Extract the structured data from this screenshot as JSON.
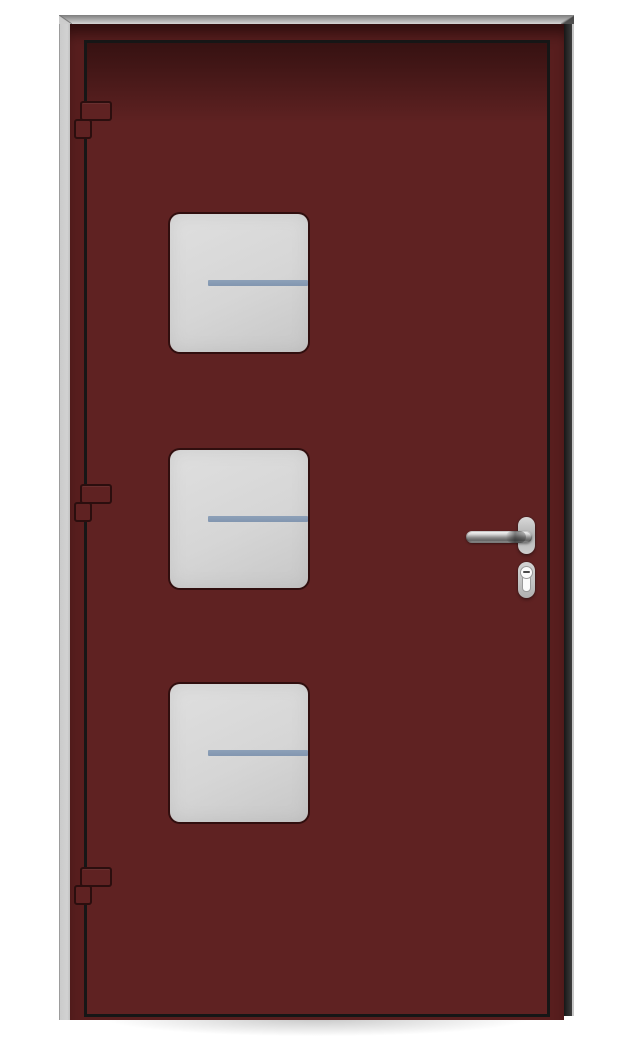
{
  "scene": {
    "subject": "front-door-illustration",
    "view": "exterior-front",
    "visible_text": ""
  },
  "colors": {
    "background": "#ffffff",
    "door": "#5f2222",
    "door_frame_face": "#581e1e",
    "door_top_shadow": "rgba(16,2,2,0.52)",
    "leaf_gap": "#161616",
    "frame_metal_light": "#cbcbcb",
    "frame_metal_dark": "#3d3d3d",
    "glass": "#d6d6d6",
    "glass_bar": "#8296b0",
    "hardware_plate": "#c3c3c3",
    "keyhole_face": "#fbfbfb",
    "ground_shadow": "rgba(70,70,70,0.30)"
  },
  "door": {
    "window_count": 3,
    "windows": [
      {
        "id": "window-top",
        "glazing_bars": 1
      },
      {
        "id": "window-middle",
        "glazing_bars": 1
      },
      {
        "id": "window-bottom",
        "glazing_bars": 1
      }
    ],
    "hinge_count": 3,
    "hinges": [
      {
        "id": "hinge-top"
      },
      {
        "id": "hinge-middle"
      },
      {
        "id": "hinge-bottom"
      }
    ],
    "hardware": {
      "lever_handle": true,
      "euro_cylinder_lock": true,
      "handle_side": "right",
      "hinge_side": "left"
    }
  }
}
